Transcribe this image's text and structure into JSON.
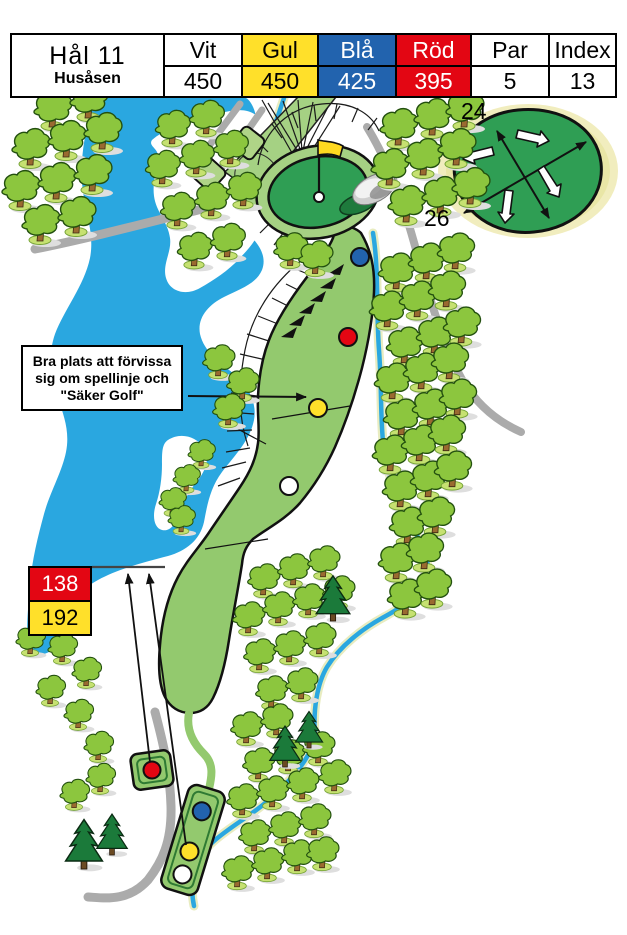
{
  "scorecard": {
    "hole": "Hål 11",
    "course": "Husåsen",
    "tees": [
      {
        "name": "Vit",
        "length": "450"
      },
      {
        "name": "Gul",
        "length": "450"
      },
      {
        "name": "Blå",
        "length": "425"
      },
      {
        "name": "Röd",
        "length": "395"
      }
    ],
    "par_label": "Par",
    "par": "5",
    "index_label": "Index",
    "index": "13"
  },
  "green_inset": {
    "back_depth": "24",
    "front_depth": "26"
  },
  "distance_markers": {
    "red_distance": "138",
    "yellow_distance": "192"
  },
  "annotation": {
    "line1": "Bra plats att förvissa",
    "line2": "sig om spellinje och",
    "line3": "\"Säker Golf\""
  },
  "colors": {
    "tee_white": "#FFFFFF",
    "tee_yellow": "#FFE02A",
    "tee_blue": "#2263AE",
    "tee_red": "#E30613",
    "water": "#2AA7E0",
    "fairway": "#93C96E",
    "green": "#2F9E54",
    "tree": "#8CC63E",
    "path": "#ABABAB"
  }
}
